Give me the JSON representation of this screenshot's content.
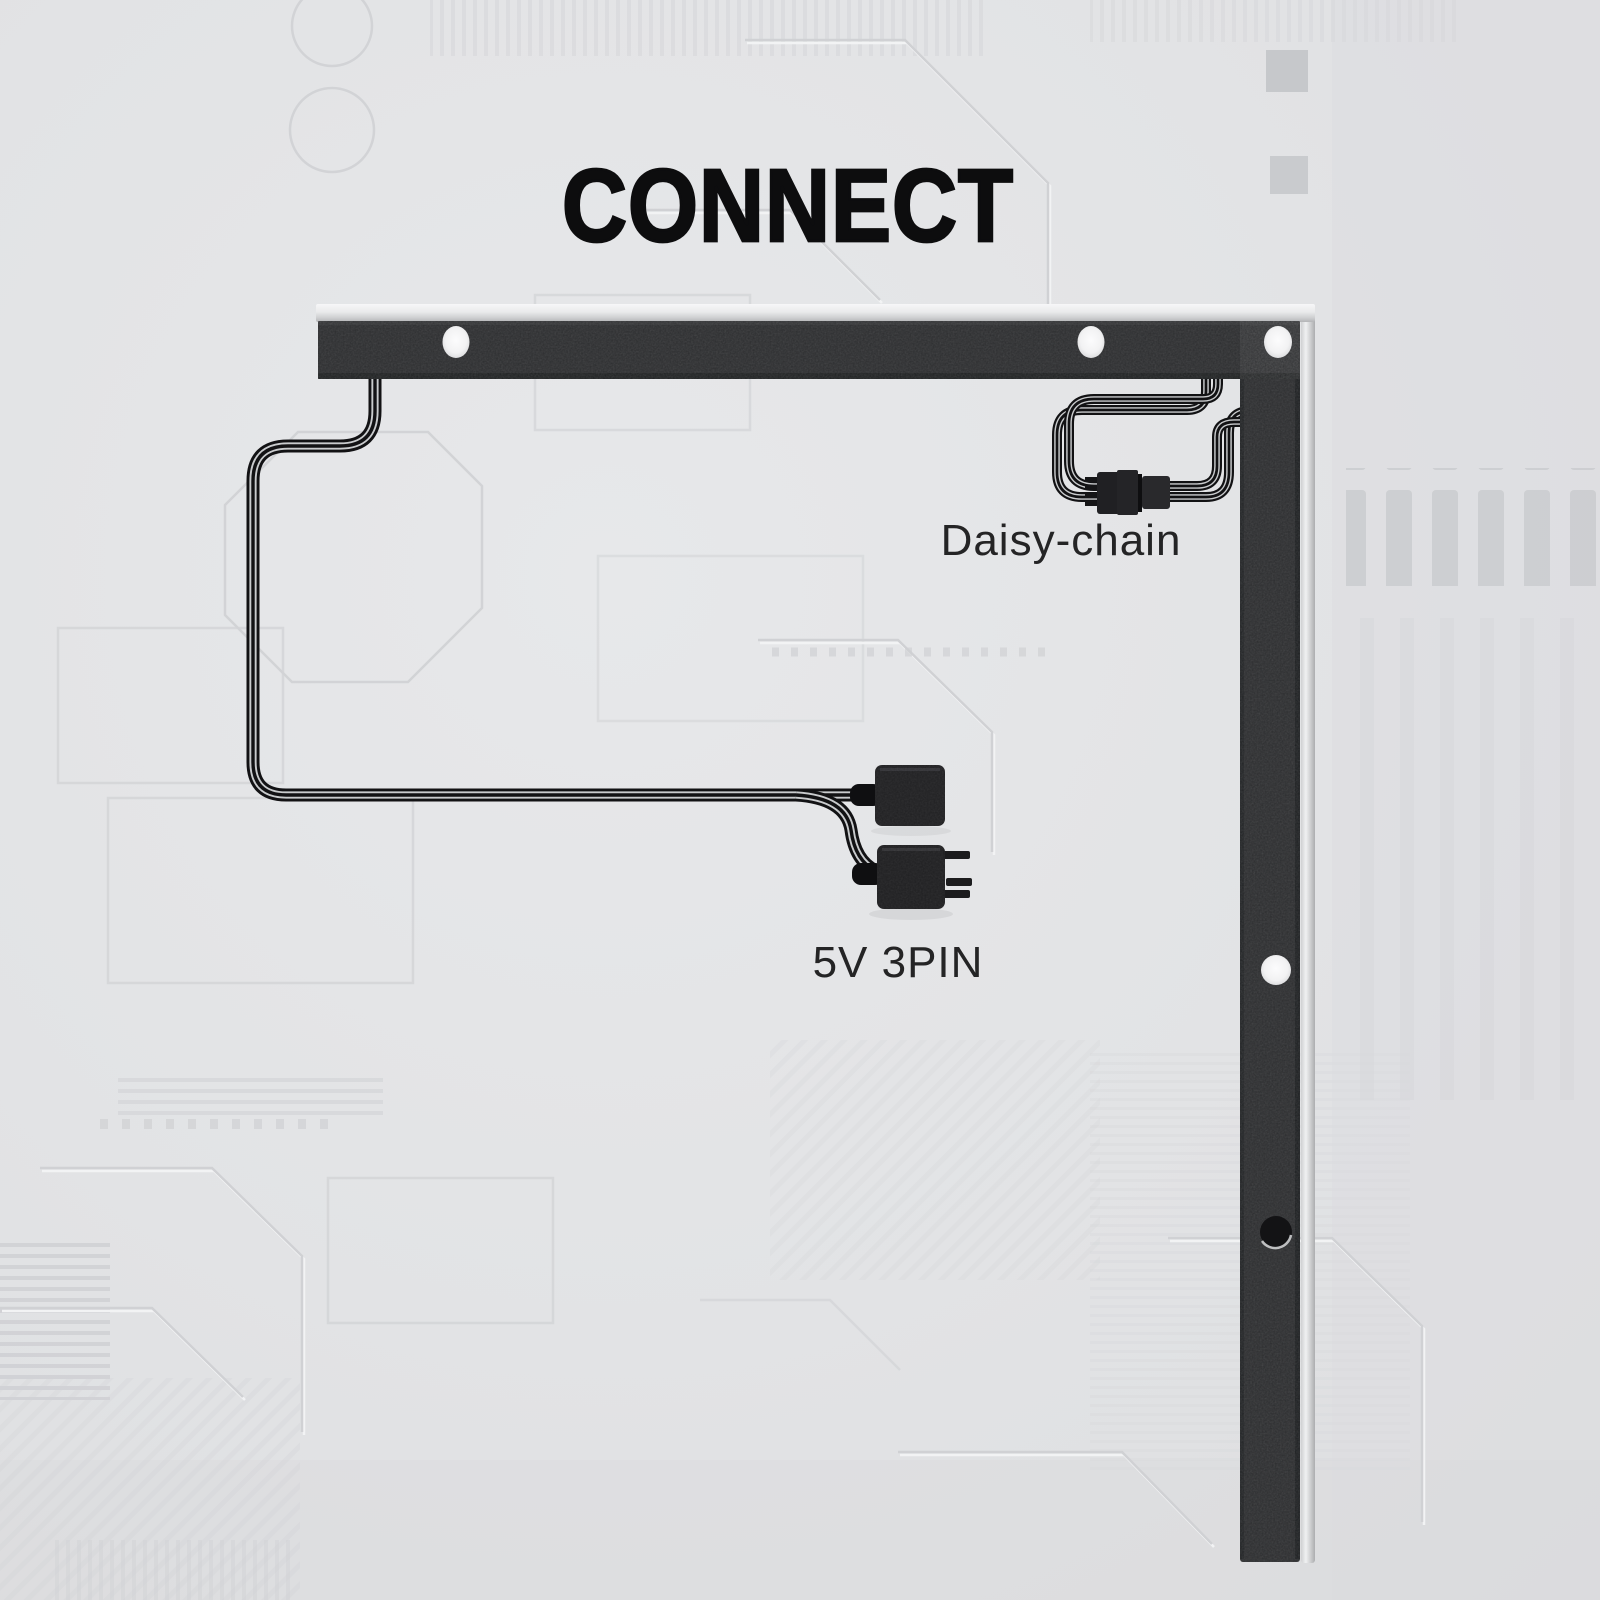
{
  "title": "CONNECT",
  "diagram": {
    "labels": {
      "daisy_chain": "Daisy-chain",
      "power_connector": "5V 3PIN"
    },
    "icons": [
      "led-strip-bracket-horizontal",
      "led-strip-bracket-vertical",
      "mounting-hole",
      "daisy-chain-cable-loop",
      "daisy-chain-connector-pair",
      "power-cable",
      "power-connector-5v-3pin-female",
      "power-connector-5v-3pin-male"
    ],
    "colors": {
      "background": "#e2e3e5",
      "bracket_black": "#2c2d2f",
      "bracket_silver_edge": "#d9dadc",
      "cable_black": "#121214",
      "title_text": "#0d0d0e",
      "label_text": "#242425"
    }
  }
}
